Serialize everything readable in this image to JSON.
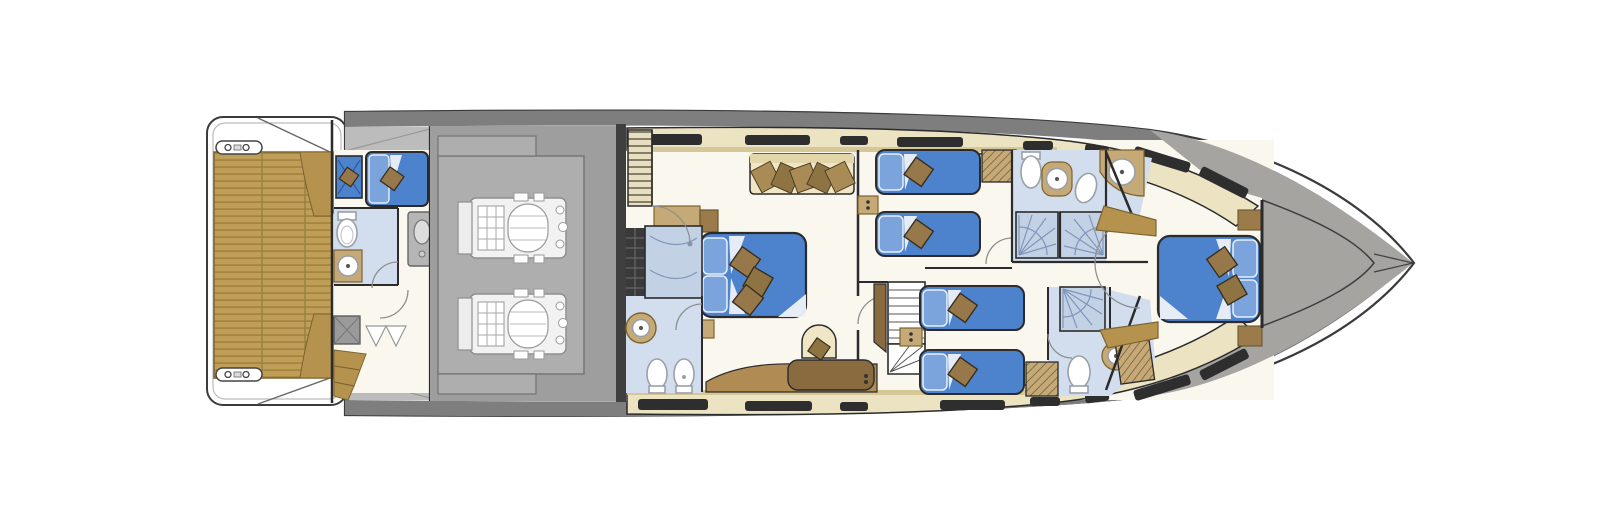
{
  "plan": {
    "type": "yacht-lower-deck-floor-plan",
    "orientation": "bow-right",
    "visible_text": "",
    "inventory": {
      "cabins": 5,
      "beds_total": 7,
      "double_beds": 2,
      "single_beds": 4,
      "crew_beds": 1,
      "bathrooms": 4,
      "showers": 4,
      "toilets": 6,
      "sinks": 6,
      "engines": 2,
      "staircases": 3,
      "sofas": 1,
      "cleats": 2,
      "windows_port": 8,
      "windows_starboard": 8
    }
  },
  "colors": {
    "background": "#ffffff",
    "hull_fill": "#ffffff",
    "hull_stroke": "#3b3b3b",
    "gunwale_gray": "#7e7e7e",
    "walkway_gray": "#bcbcbc",
    "bow_deck_gray": "#a6a4a1",
    "engine_room_gray": "#9e9e9e",
    "engine_panel_gray": "#aeaeae",
    "engine_white": "#f2f2f2",
    "teak": "#bf9e57",
    "teak_stripe": "#a5853f",
    "teak_wedge": "#b5934e",
    "cream_band": "#ece3c2",
    "cream_trim": "#d6c896",
    "sofa_cream": "#efe6c6",
    "window_dark": "#2e2e2e",
    "floor_white": "#faf7ef",
    "bath_floor_blue": "#d2deee",
    "shower_blue": "#c3d1e5",
    "shower_dark_frame": "#3a3a3a",
    "bed_blue": "#4d82cc",
    "bed_blue_light": "#7ba4dd",
    "pillow_white": "#f2f5fa",
    "cushion_brown": "#97784a",
    "cushion_brown_dark": "#8f7443",
    "wood": "#c5a977",
    "wood_dark": "#9c7b4a",
    "wood_deep": "#8a6b3f",
    "wall_dark": "#2b2b2b"
  }
}
